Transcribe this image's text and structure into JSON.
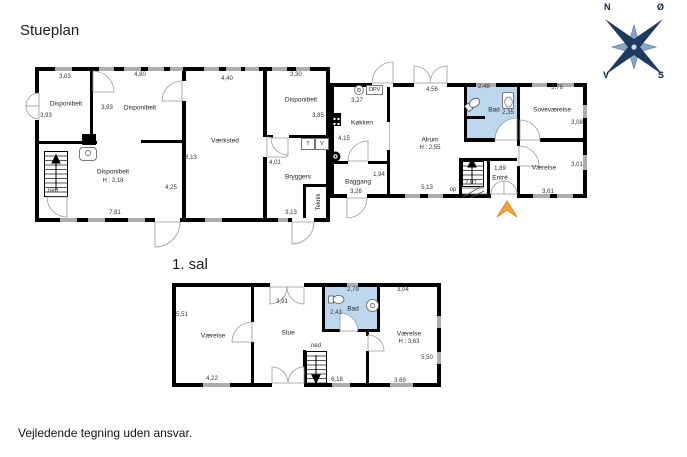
{
  "titles": {
    "ground": "Stueplan",
    "first": "1. sal"
  },
  "disclaimer": "Vejledende tegning uden ansvar.",
  "compass": {
    "n": "N",
    "e": "Ø",
    "s": "S",
    "w": "V"
  },
  "colors": {
    "wall": "#000000",
    "window": "#adadad",
    "bath": "#bdd7ee",
    "arrow": "#f2a43c",
    "compass_dark": "#1e3a5e",
    "compass_light": "#8aa5c8"
  },
  "ground": {
    "disponibelt_tl": {
      "label": "Disponibelt",
      "dim_top": "3,03",
      "dim_left": "3,93",
      "dim_right": "3,93"
    },
    "disponibelt_mid": {
      "label": "Disponibelt",
      "dim_top": "4,80"
    },
    "disponibelt_big": {
      "label": "Disponibelt",
      "ceiling": "H : 2,18",
      "dim_bottom": "7,81",
      "dim_right": "4,25"
    },
    "vaerksted": {
      "label": "Værksted",
      "dim_top": "4,40",
      "dim_left": "8,13"
    },
    "disponibelt_tr": {
      "label": "Disponibelt",
      "dim_top": "3,30",
      "dim_right": "3,85"
    },
    "bryggers": {
      "label": "Bryggers",
      "dim_left": "4,01",
      "dim_bottom": "3,13"
    },
    "teknik": {
      "label": "Teknik"
    },
    "koekken": {
      "label": "Køkken",
      "dim_top": "3,27",
      "dim_left": "4,15"
    },
    "alrum": {
      "label": "Alrum",
      "ceiling": "H : 2,55",
      "dim_top": "4,56",
      "dim_bottom": "5,13"
    },
    "baggang": {
      "label": "Baggang",
      "dim_right": "1,94",
      "dim_bottom": "3,26"
    },
    "bad": {
      "label": "Bad",
      "dim_top": "2,48",
      "dim_right": "2,35"
    },
    "sovevaerelse": {
      "label": "Soveværelse",
      "dim_top": "3,76",
      "dim_right": "3,08"
    },
    "vaerelse": {
      "label": "Værelse",
      "dim_right": "3,01",
      "dim_bottom": "3,61"
    },
    "entre": {
      "label": "Entré",
      "dim_top": "1,89",
      "dim_left": "2,01"
    },
    "stairs_down": "ned",
    "stairs_up": "op",
    "appliance_t": "T",
    "appliance_v": "V",
    "appliance_opv": "OPV"
  },
  "first": {
    "vaerelse_left": {
      "label": "Værelse",
      "dim_left": "5,51",
      "dim_bottom": "4,22"
    },
    "stue": {
      "label": "Stue",
      "dim_top": "3,91"
    },
    "bad": {
      "label": "Bad",
      "dim_top": "2,79",
      "dim_left": "2,43"
    },
    "vaerelse_right": {
      "label": "Værelse",
      "ceiling": "H : 3,63",
      "dim_top": "3,04",
      "dim_right": "5,50",
      "dim_bottom": "3,69"
    },
    "stairs_down": "ned",
    "dim_stairs": "6,18"
  }
}
